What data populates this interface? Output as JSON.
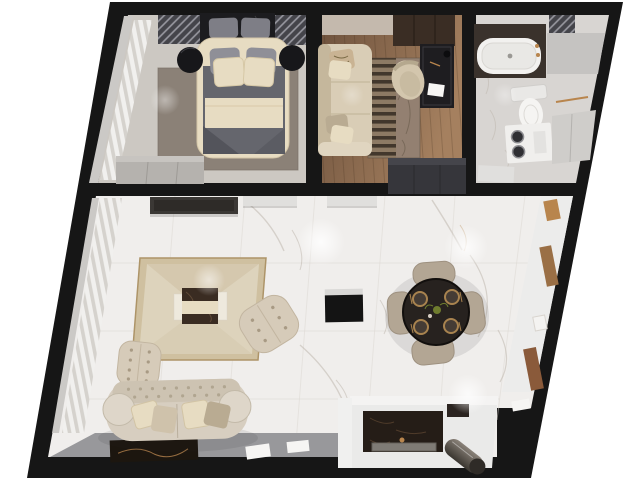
{
  "scene": {
    "title": "Top-down 3D render of a one-bedroom apartment floor plan",
    "view": "top-down interior render, plan skewed left, black wall outline on white page",
    "has_text": false
  },
  "palette": {
    "page-bg": "#ffffff",
    "wall": "#161616",
    "sill-gray": "#cbc9c6",
    "bedroom-floor": "#ccc8c2",
    "bedroom-rug": "#8b8177",
    "duvet": "#65666d",
    "duvet-dark": "#53545b",
    "linen-cream": "#e7dcc2",
    "pillow-gray": "#8f8f97",
    "pillow-gray-dark": "#7e7e86",
    "headboard": "#1c1c1f",
    "hatch-bg": "#44444a",
    "hatch-line": "#9a9aa2",
    "nightstand": "#17171a",
    "wardrobe-gray": "#b5b2ae",
    "wardrobe-gray-top": "#c7c4c0",
    "curtain-a": "#f1f0ee",
    "curtain-b": "#d5d2cd",
    "office-wall": "#c4b9ad",
    "office-wardrobe": "#3a2d24",
    "office-floor-dark": "#6e523d",
    "office-floor-light": "#a5805f",
    "office-sofa": "#d9cdb6",
    "office-sofa-dark": "#c5b79c",
    "office-sofa-arm": "#e0d5c0",
    "office-rug-base": "#8d7a64",
    "office-rug-stripe": "#42372c",
    "office-rug-right": "#938071",
    "desk": "#1e1d20",
    "office-chair": "#d3c6ad",
    "office-cabinet": "#36363b",
    "office-cabinet-top": "#45454b",
    "bath-floor": "#d8d5d2",
    "bath-dark-tile": "#3a322c",
    "tub": "#f2f1ef",
    "tub-inner": "#e9e8e5",
    "tub-rim": "#d9d7d3",
    "porcelain": "#f5f4f2",
    "bath-gray-panel": "#c5c3c1",
    "bath-cabinet": "#cfcdca",
    "washer": "#f0efed",
    "washer-drum": "#2f2f33",
    "washer-ring": "#8e8e92",
    "living-floor": "#f0eeec",
    "marble-vein": "#bfb8ae",
    "tile-seam": "#dcd8d2",
    "living-rug": "#ddd3bc",
    "living-rug-border": "#cfc0a0",
    "rug-outline": "#ad9468",
    "rug-sheen": "#cdbfa2",
    "coffee-table": "#3a2c22",
    "coffee-table-streak": "#5f4936",
    "armchair": "#d6cbb9",
    "armchair-shade": "#c2b5a0",
    "button-dot": "#a89a84",
    "sofa": "#d7cec0",
    "sofa-back": "#cdc3b2",
    "sofa-arm": "#ded6c9",
    "sofa-seam": "#b9ae9c",
    "pillow-taupe": "#b9ab92",
    "pillow-sand": "#cfc2ab",
    "balcony-floor": "#98989b",
    "art-dark": "#1c160f",
    "gold": "#b8854d",
    "paper-white": "#f6f5f3",
    "tv-console": "#3b3835",
    "floor-cabinet": "#141414",
    "cabinet-top-bar": "#d9d8d6",
    "dining-table": "#27221f",
    "dining-table-edge": "#120f0d",
    "dining-chair": "#b3a694",
    "dining-chair-shade": "#9e9180",
    "plate-gold": "#a8834f",
    "plate-dark": "#453c35",
    "plant-green": "#6f7c2e",
    "kitchen-white": "#eaeae9",
    "kitchen-backsplash": "#f4f3f2",
    "kitchen-pillar": "#f0f0ef",
    "kitchen-dark": "#251d17",
    "kitchen-streak": "#5a4330",
    "steel": "#8f8c86",
    "cylinder-light": "#8a8279",
    "cylinder-dark": "#3a3630",
    "cylinder-cap": "#2f2b27",
    "shelf-white": "#ececeb",
    "door-leaf": "#e0dfdd",
    "shadow": "#2b2b2b",
    "art-bronze": "#9a6f45",
    "art-red": "#8a5a3a"
  },
  "rooms": [
    {
      "id": "bedroom",
      "label": "Bedroom",
      "furniture": [
        "double-bed",
        "headboard-panels",
        "nightstand-left",
        "nightstand-right",
        "bedroom-rug",
        "low-wardrobe",
        "window-curtains"
      ]
    },
    {
      "id": "study",
      "label": "Study room",
      "furniture": [
        "corner-sofa",
        "striped-rug",
        "desk",
        "desk-chair",
        "dark-wardrobe",
        "low-cabinet"
      ]
    },
    {
      "id": "bathroom",
      "label": "Bathroom",
      "furniture": [
        "bathtub",
        "toilet",
        "washing-machine-vanity",
        "storage-cabinet",
        "glass-panel",
        "open-door"
      ]
    },
    {
      "id": "living",
      "label": "Living room and kitchen",
      "furniture": [
        "tv-console",
        "area-rug",
        "coffee-table",
        "armchair-right",
        "armchair-left",
        "curved-sofa",
        "floor-cabinet",
        "dining-table",
        "dining-chairs",
        "wall-shelf-with-art",
        "kitchen-counter",
        "kitchen-sink",
        "balcony-strip",
        "floor-art-board",
        "papers"
      ]
    }
  ],
  "lights": {
    "ceiling_glow_spots": 4,
    "color": "#ffffff"
  }
}
